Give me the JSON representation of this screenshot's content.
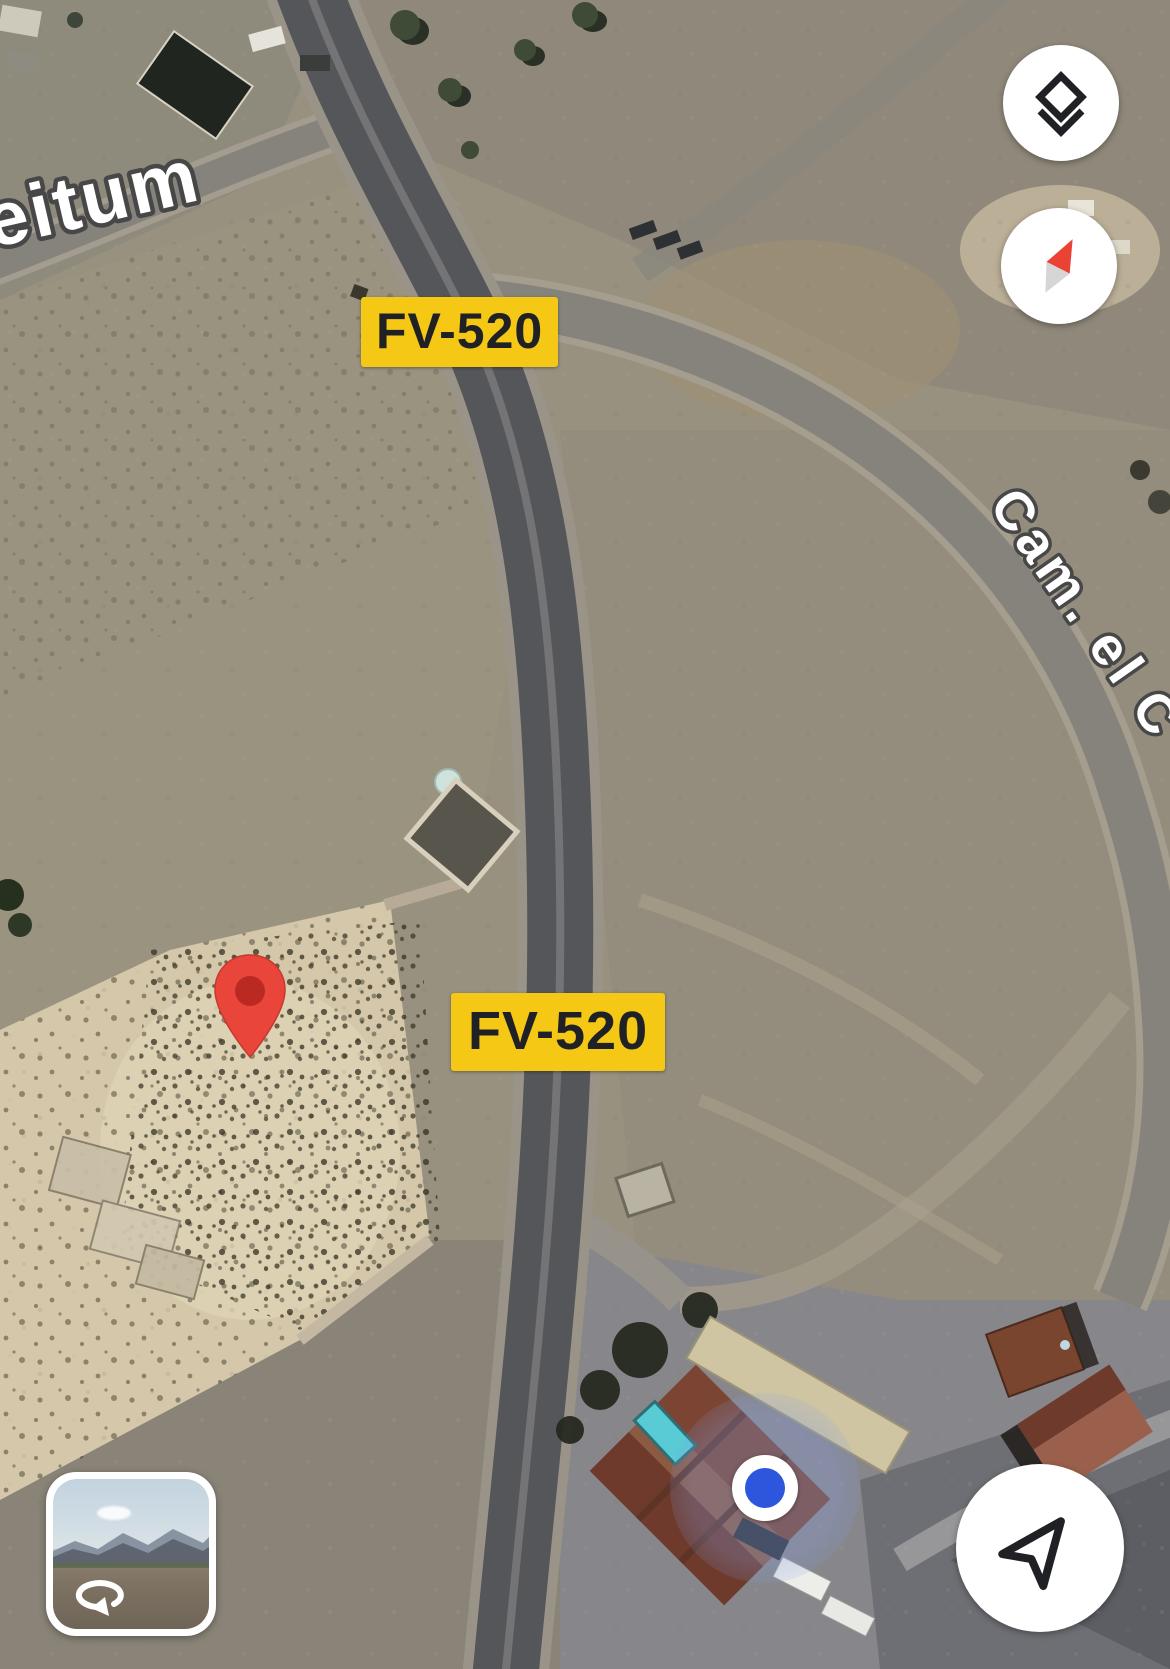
{
  "road_labels": {
    "badges": [
      {
        "text": "FV-520"
      },
      {
        "text": "FV-520"
      }
    ]
  },
  "street_names": [
    {
      "text": "eitum"
    },
    {
      "text": "Cam. el C"
    }
  ],
  "controls": {
    "layers": {
      "icon": "layers-icon"
    },
    "compass": {
      "icon": "compass-needle-icon"
    },
    "navigate": {
      "icon": "navigate-arrow-icon"
    },
    "street_view_preview": {
      "icon": "rotate-360-icon"
    }
  },
  "markers": {
    "destination_pin": {
      "icon": "map-pin-icon"
    },
    "current_location": {
      "icon": "location-dot-icon"
    }
  },
  "colors": {
    "badge_yellow": "#F5C816",
    "badge_text": "#202124",
    "pin_red": "#E9453A",
    "pin_inner": "#B3261E",
    "location_blue": "#2E56DD",
    "compass_red": "#EA4335",
    "icon_dark": "#202125",
    "button_bg": "#FFFFFF"
  }
}
